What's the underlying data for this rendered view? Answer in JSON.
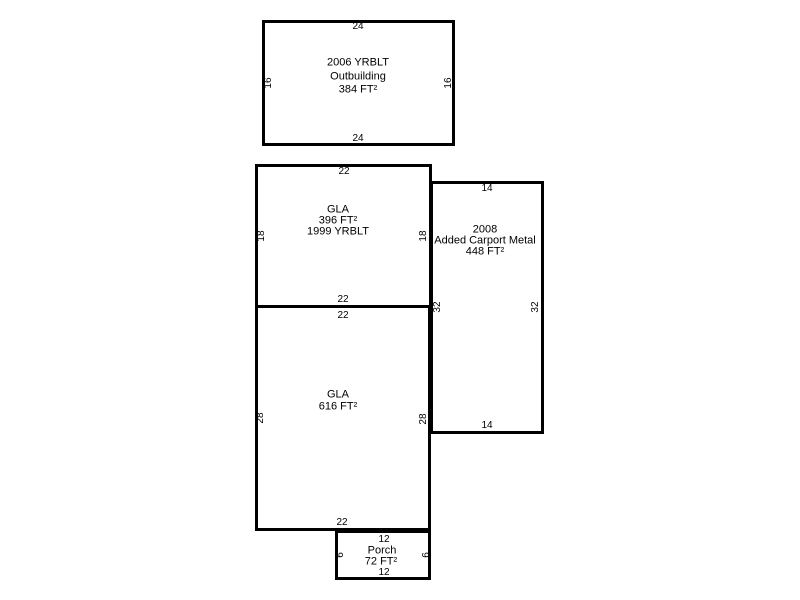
{
  "canvas": {
    "background_color": "#ffffff",
    "line_color": "#000000",
    "width_px": 800,
    "height_px": 600
  },
  "shapes": {
    "outbuilding": {
      "lines": [
        "2006 YRBLT",
        "Outbuilding",
        "384 FT²"
      ],
      "dims": {
        "top": "24",
        "bottom": "24",
        "left": "16",
        "right": "16"
      }
    },
    "gla_upper": {
      "lines": [
        "GLA",
        "396 FT²",
        "1999 YRBLT"
      ],
      "dims": {
        "top": "22",
        "bottom": "22",
        "left": "18",
        "right": "18"
      }
    },
    "carport": {
      "lines": [
        "2008",
        "Added Carport Metal",
        "448 FT²"
      ],
      "dims": {
        "top": "14",
        "bottom": "14",
        "left": "32",
        "right": "32"
      }
    },
    "gla_lower": {
      "lines": [
        "GLA",
        "616 FT²"
      ],
      "dims": {
        "top": "22",
        "bottom": "22",
        "left": "28",
        "right": "28"
      }
    },
    "porch": {
      "lines": [
        "Porch",
        "72 FT²"
      ],
      "dims": {
        "top": "12",
        "bottom": "12",
        "left": "6",
        "right": "6"
      }
    }
  }
}
